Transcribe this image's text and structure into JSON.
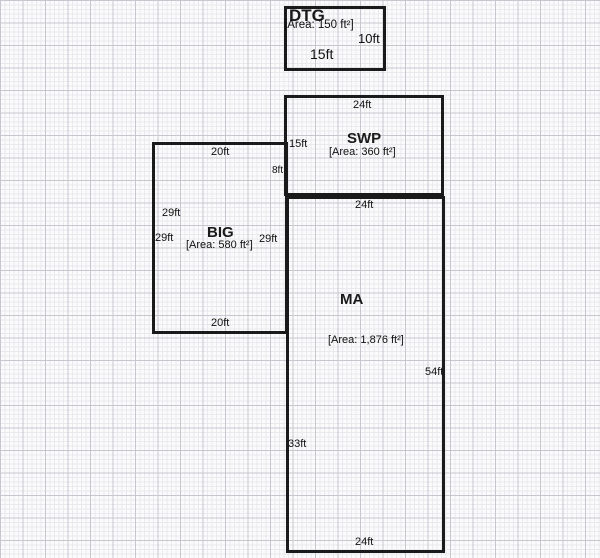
{
  "diagram_type": "floor-plan",
  "rooms": {
    "dtg": {
      "name": "DTG",
      "area": "[Area: 150 ft²]",
      "dims": {
        "right": "10ft",
        "bottom": "15ft"
      }
    },
    "swp": {
      "name": "SWP",
      "area": "[Area: 360 ft²]",
      "dims": {
        "top": "24ft",
        "left": "15ft"
      }
    },
    "big": {
      "name": "BIG",
      "area": "[Area: 580 ft²]",
      "dims": {
        "top": "20ft",
        "right_upper": "8ft",
        "left_upper": "29ft",
        "left_lower": "29ft",
        "right": "29ft",
        "bottom": "20ft"
      }
    },
    "ma": {
      "name": "MA",
      "area": "[Area: 1,876 ft²]",
      "dims": {
        "top": "24ft",
        "right": "54ft",
        "left": "33ft",
        "bottom": "24ft"
      }
    }
  },
  "colors": {
    "wall": "#1a1a1a",
    "paper": "#fbfbfb",
    "grid_minor": "#e9e9ef",
    "grid_major": "#c7c7d2",
    "text": "#111111"
  }
}
